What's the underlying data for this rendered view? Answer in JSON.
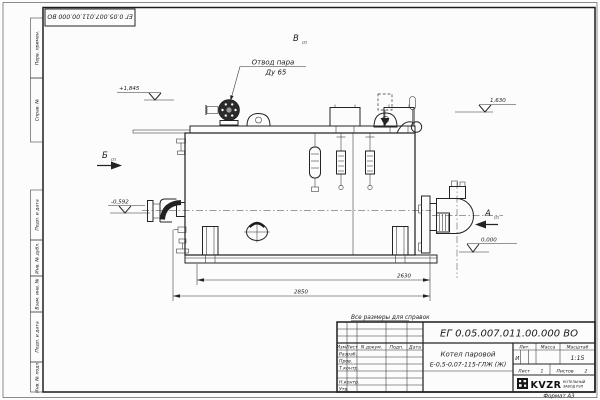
{
  "page": {
    "format": "Формат А3",
    "note": "Все размеры для справок"
  },
  "stamps": {
    "doc_number_top": "ЕГ 0.05.007.011.00.000  ВО",
    "side_labels": [
      "Перв. примен.",
      "Справ. №",
      "Подп. и дата",
      "Инв. № дубл.",
      "Взам. инв. №",
      "Подп. и дата",
      "Инв. № подл."
    ]
  },
  "drawing": {
    "leader_line1": "Отвод пара",
    "leader_line2": "Ду 65",
    "elev_top_left": "+1,845",
    "elev_mid_left": "-0,592",
    "elev_top_right": "1,630",
    "elev_zero": "0,000",
    "view_b": "Б",
    "view_v": "В",
    "view_a": "А",
    "view_ref": "(2)",
    "dim_inner": "2630",
    "dim_outer": "2850"
  },
  "title_block": {
    "doc_number": "ЕГ 0.05.007.011.00.000  ВО",
    "product_line1": "Котел паровой",
    "product_line2": "Е-0,5-0,07-115-ГЛЖ (Ж)",
    "cols": {
      "izm": "Изм.",
      "list": "Лист",
      "doc": "N докум.",
      "sign": "Подп.",
      "date": "Дата"
    },
    "roles": [
      "Разраб.",
      "Пров.",
      "Т.контр.",
      "Н.контр.",
      "Утв."
    ],
    "lit_label": "Лит.",
    "lit_value": "И",
    "mass_label": "Масса",
    "scale_label": "Масштаб",
    "scale_value": "1:15",
    "sheet_label": "Лист",
    "sheet_value": "1",
    "sheets_label": "Листов",
    "sheets_value": "2",
    "brand": "KVZR",
    "brand_line1": "КОТЕЛЬНЫЙ",
    "brand_line2": "ЗАВОД РЭП"
  }
}
